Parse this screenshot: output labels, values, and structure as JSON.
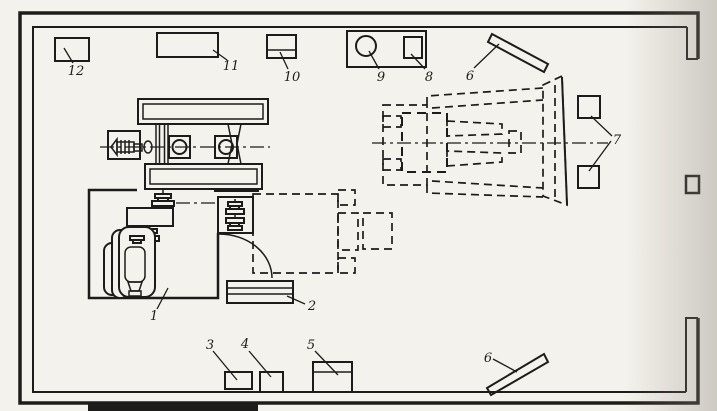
{
  "diagram": {
    "background_color": "#f4f2ec",
    "line_color": "#1e1c1a",
    "labels": {
      "n1": "1",
      "n2": "2",
      "n3": "3",
      "n4": "4",
      "n5": "5",
      "n6a": "6",
      "n6b": "6",
      "n7": "7",
      "n8": "8",
      "n9": "9",
      "n10": "10",
      "n11": "11",
      "n12": "12"
    }
  }
}
